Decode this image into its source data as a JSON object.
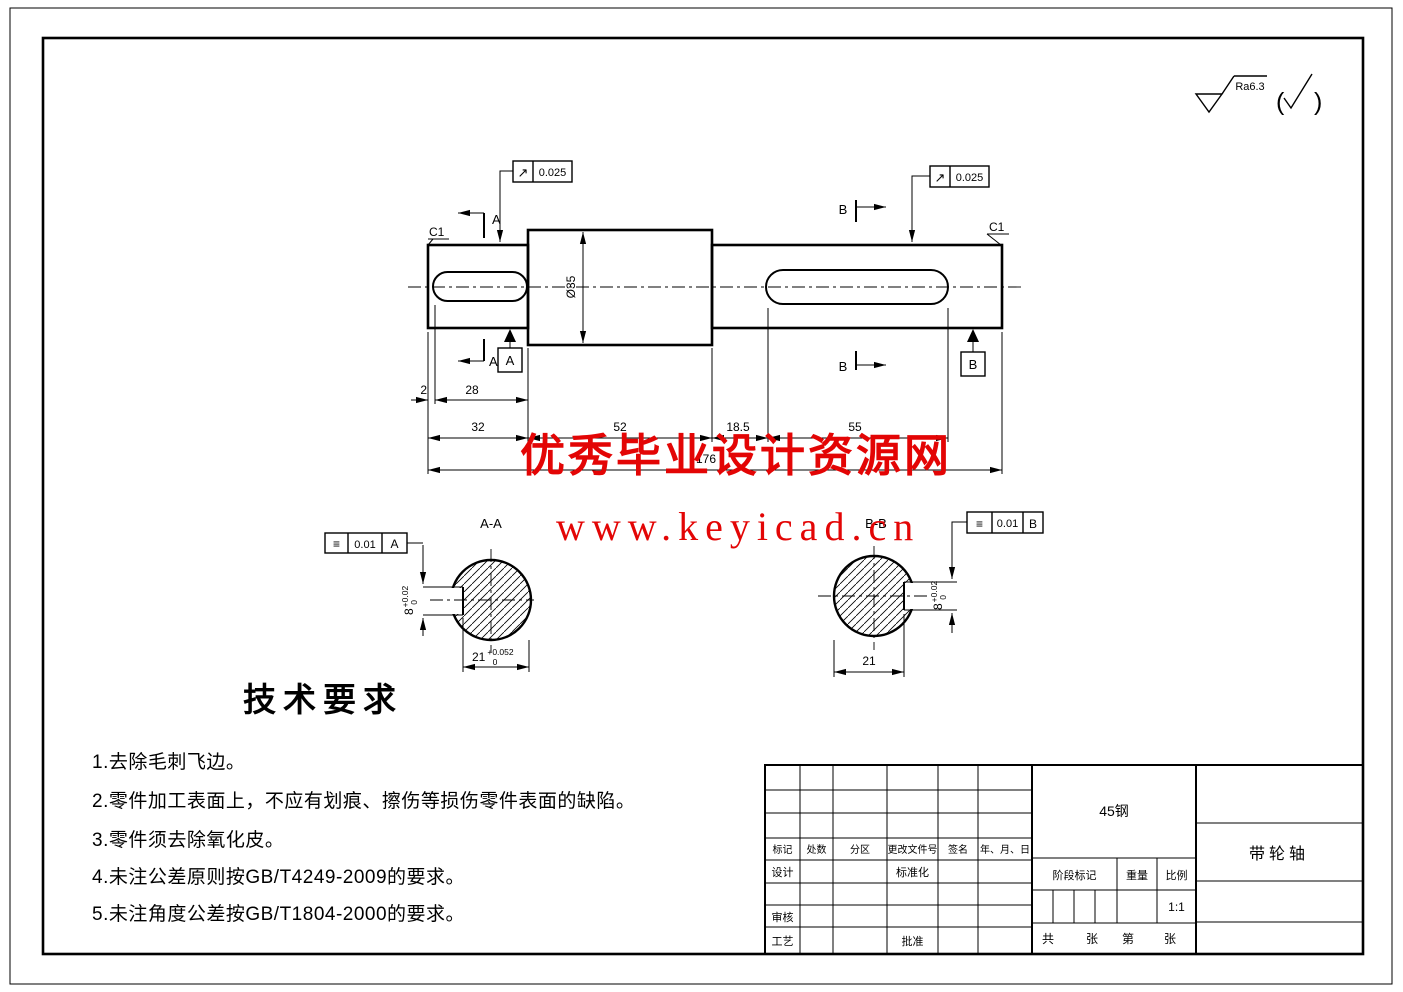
{
  "roughness": {
    "value": "Ra6.3"
  },
  "watermark": {
    "line1": "优秀毕业设计资源网",
    "line2": "www.keyicad.cn",
    "color": "#e30505"
  },
  "main_view": {
    "chamfer_left": "C1",
    "chamfer_right": "C1",
    "diameter": "Ø35",
    "cut_a": "A",
    "cut_b": "B",
    "datum_a": "A",
    "datum_b": "B",
    "runout_symbol": "↗",
    "runout_left_value": "0.025",
    "runout_right_value": "0.025",
    "dims": {
      "end_gap": "2",
      "left_key_len": "28",
      "left_seg": "32",
      "mid_seg": "52",
      "shoulder_gap": "18.5",
      "right_key_len": "55",
      "overall": "176"
    }
  },
  "section_aa": {
    "title": "A-A",
    "tol_symbol": "≡",
    "tol_value": "0.01",
    "tol_datum": "A",
    "key_width": "8",
    "key_width_up": "+0.02",
    "key_width_low": "0",
    "depth": "21",
    "depth_up": "+0.052",
    "depth_low": "0"
  },
  "section_bb": {
    "title": "B-B",
    "tol_symbol": "≡",
    "tol_value": "0.01",
    "tol_datum": "B",
    "key_width": "8",
    "key_width_up": "+0.02",
    "key_width_low": "0",
    "depth": "21"
  },
  "tech": {
    "title": "技术要求",
    "items": [
      "1.去除毛刺飞边。",
      "2.零件加工表面上，不应有划痕、擦伤等损伤零件表面的缺陷。",
      "3.零件须去除氧化皮。",
      "4.未注公差原则按GB/T4249-2009的要求。",
      "5.未注角度公差按GB/T1804-2000的要求。"
    ]
  },
  "title_block": {
    "material": "45钢",
    "part_name": "带轮轴",
    "rev_headers": [
      "标记",
      "处数",
      "分区",
      "更改文件号",
      "签名",
      "年、月、日"
    ],
    "design": "设计",
    "standardization": "标准化",
    "check": "审核",
    "process": "工艺",
    "approve": "批准",
    "stage": "阶段标记",
    "weight": "重量",
    "scale": "比例",
    "scale_value": "1:1",
    "sheet_total": "共",
    "sheet_total_unit": "张",
    "sheet_no": "第",
    "sheet_no_unit": "张"
  }
}
